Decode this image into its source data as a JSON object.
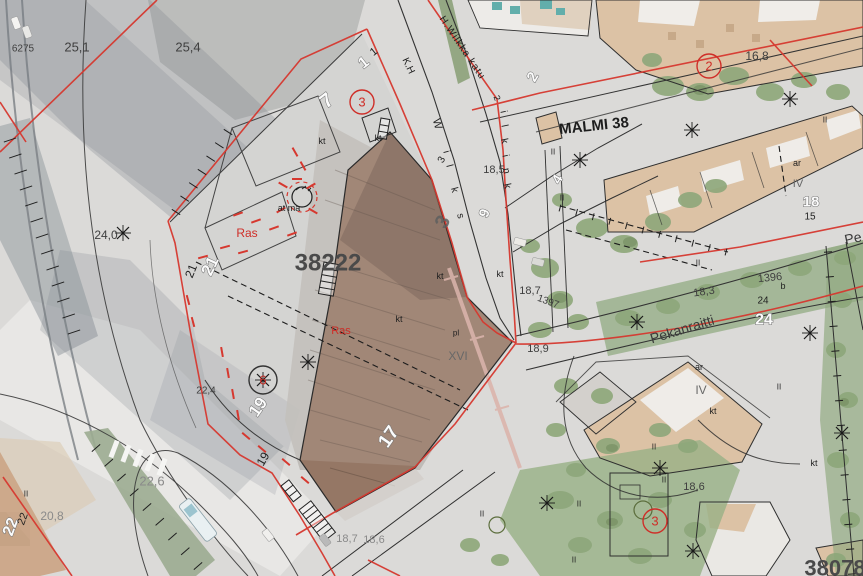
{
  "meta": {
    "map_type": "cadastral city-plan overlay on aerial photo",
    "district_label": "MALMI 38",
    "main_block_number": "38222",
    "secondary_block_number": "38078",
    "street_names": [
      "Pekanraitti",
      "H.Wilkka katu"
    ],
    "easement_label": "Ras"
  },
  "colors": {
    "red_line": "#d6382f",
    "plan_black": "#222222",
    "block_gray": "#4a4a4a",
    "photo_green": "#84a06f",
    "roof_beige": "#d9bd9e",
    "roof_brown": "#8c6c58",
    "teal_roof": "#55a8a4"
  },
  "labels": [
    {
      "n": "spot-height-6275",
      "t": "6275",
      "x": 23,
      "y": 49,
      "s": 10,
      "r": 0,
      "st": "elev"
    },
    {
      "n": "spot-height-25-1",
      "t": "25,1",
      "x": 77,
      "y": 47,
      "s": 13,
      "r": 0,
      "st": "elev"
    },
    {
      "n": "spot-height-25-4",
      "t": "25,4",
      "x": 188,
      "y": 47,
      "s": 13,
      "r": 0,
      "st": "elev"
    },
    {
      "n": "spot-height-24-0",
      "t": "24,0",
      "x": 106,
      "y": 235,
      "s": 12,
      "r": 0,
      "st": "elev"
    },
    {
      "n": "spot-height-18-5",
      "t": "18,5",
      "x": 494,
      "y": 170,
      "s": 11,
      "r": 0,
      "st": "elev"
    },
    {
      "n": "spot-height-18-7",
      "t": "18,7",
      "x": 530,
      "y": 291,
      "s": 11,
      "r": 0,
      "st": "elev"
    },
    {
      "n": "spot-height-18-9",
      "t": "18,9",
      "x": 538,
      "y": 349,
      "s": 11,
      "r": 0,
      "st": "elev"
    },
    {
      "n": "spot-height-16-8",
      "t": "16,8",
      "x": 757,
      "y": 56,
      "s": 12,
      "r": 0,
      "st": "elev"
    },
    {
      "n": "spot-height-18-3",
      "t": "18,3",
      "x": 704,
      "y": 292,
      "s": 11,
      "r": -8,
      "st": "elev"
    },
    {
      "n": "spot-height-22-4",
      "t": "22,4",
      "x": 206,
      "y": 391,
      "s": 10,
      "r": 0,
      "st": "elev"
    },
    {
      "n": "spot-height-22-6",
      "t": "22,6",
      "x": 152,
      "y": 481,
      "s": 13,
      "r": 0,
      "st": "elevlight"
    },
    {
      "n": "spot-height-20-8",
      "t": "20,8",
      "x": 52,
      "y": 516,
      "s": 12,
      "r": 0,
      "st": "elevlight"
    },
    {
      "n": "spot-height-18-6",
      "t": "18,6",
      "x": 694,
      "y": 487,
      "s": 11,
      "r": 0,
      "st": "elev"
    },
    {
      "n": "spot-height-18-7-b",
      "t": "18,7",
      "x": 347,
      "y": 539,
      "s": 11,
      "r": 0,
      "st": "elevlight"
    },
    {
      "n": "spot-height-18-6-b",
      "t": "18,6",
      "x": 374,
      "y": 540,
      "s": 11,
      "r": 0,
      "st": "elevlight"
    },
    {
      "n": "benchmark-1397",
      "t": "1397",
      "x": 548,
      "y": 302,
      "s": 10,
      "r": 20,
      "st": "elev"
    },
    {
      "n": "benchmark-1396",
      "t": "1396",
      "x": 770,
      "y": 278,
      "s": 11,
      "r": -6,
      "st": "elev"
    },
    {
      "n": "block-number-38222",
      "t": "38222",
      "x": 328,
      "y": 263,
      "s": 24,
      "r": 0,
      "st": "block"
    },
    {
      "n": "block-number-38078",
      "t": "38078",
      "x": 835,
      "y": 568,
      "s": 22,
      "r": 0,
      "st": "block"
    },
    {
      "n": "lot-number-7",
      "t": "7",
      "x": 327,
      "y": 101,
      "s": 20,
      "r": -38,
      "st": "lotw"
    },
    {
      "n": "lot-number-1",
      "t": "1",
      "x": 364,
      "y": 63,
      "s": 16,
      "r": -38,
      "st": "lotw"
    },
    {
      "n": "lot-number-1-b",
      "t": "1",
      "x": 374,
      "y": 52,
      "s": 11,
      "r": -38,
      "st": "smb"
    },
    {
      "n": "lot-number-21",
      "t": "21",
      "x": 210,
      "y": 266,
      "s": 17,
      "r": -65,
      "st": "lotw"
    },
    {
      "n": "lot-number-21-b",
      "t": "21",
      "x": 191,
      "y": 271,
      "s": 12,
      "r": -68,
      "st": "smb"
    },
    {
      "n": "lot-number-19",
      "t": "19",
      "x": 258,
      "y": 407,
      "s": 17,
      "r": -55,
      "st": "lotw"
    },
    {
      "n": "lot-number-19-b",
      "t": "19",
      "x": 263,
      "y": 459,
      "s": 12,
      "r": -60,
      "st": "smb"
    },
    {
      "n": "lot-number-17",
      "t": "17",
      "x": 389,
      "y": 437,
      "s": 19,
      "r": -55,
      "st": "lotw"
    },
    {
      "n": "lot-number-22",
      "t": "22",
      "x": 11,
      "y": 527,
      "s": 16,
      "r": -70,
      "st": "lotw"
    },
    {
      "n": "lot-number-22-b",
      "t": "22",
      "x": 23,
      "y": 519,
      "s": 11,
      "r": -70,
      "st": "smb"
    },
    {
      "n": "lot-number-2",
      "t": "2",
      "x": 533,
      "y": 77,
      "s": 15,
      "r": -60,
      "st": "lotw"
    },
    {
      "n": "lot-number-4",
      "t": "4",
      "x": 557,
      "y": 179,
      "s": 14,
      "r": -60,
      "st": "lotw"
    },
    {
      "n": "lot-number-24",
      "t": "24",
      "x": 764,
      "y": 320,
      "s": 16,
      "r": 0,
      "st": "lotw"
    },
    {
      "n": "lot-number-24-b",
      "t": "24",
      "x": 763,
      "y": 301,
      "s": 10,
      "r": 0,
      "st": "smb"
    },
    {
      "n": "lot-number-18",
      "t": "18",
      "x": 811,
      "y": 202,
      "s": 15,
      "r": 0,
      "st": "lotw"
    },
    {
      "n": "lot-number-15",
      "t": "15",
      "x": 810,
      "y": 217,
      "s": 10,
      "r": 0,
      "st": "smb"
    },
    {
      "n": "lot-number-9",
      "t": "9",
      "x": 484,
      "y": 213,
      "s": 14,
      "r": -70,
      "st": "lotw"
    },
    {
      "n": "lot-number-3-small",
      "t": "3",
      "x": 442,
      "y": 160,
      "s": 10,
      "r": -60,
      "st": "smb"
    },
    {
      "n": "lot-number-3-roof",
      "t": "3",
      "x": 443,
      "y": 222,
      "s": 20,
      "r": -60,
      "st": "blockmed"
    },
    {
      "n": "roman-floors-xvi",
      "t": "XVI",
      "x": 458,
      "y": 356,
      "s": 12,
      "r": 0,
      "st": "gray"
    },
    {
      "n": "roman-floors-iv",
      "t": "IV",
      "x": 701,
      "y": 390,
      "s": 12,
      "r": 0,
      "st": "gray"
    },
    {
      "n": "roman-floors-iv-b",
      "t": "IV",
      "x": 798,
      "y": 184,
      "s": 11,
      "r": 0,
      "st": "gray"
    },
    {
      "n": "note-pl",
      "t": "pl",
      "x": 456,
      "y": 333,
      "s": 8,
      "r": 0,
      "st": "smb"
    },
    {
      "n": "note-ar",
      "t": "ar",
      "x": 699,
      "y": 367,
      "s": 9,
      "r": 0,
      "st": "smb"
    },
    {
      "n": "note-ar-b",
      "t": "ar",
      "x": 797,
      "y": 163,
      "s": 9,
      "r": 0,
      "st": "smb"
    },
    {
      "n": "note-at-ma",
      "t": "at ma",
      "x": 289,
      "y": 208,
      "s": 9,
      "r": 0,
      "st": "smb"
    },
    {
      "n": "note-kt-1",
      "t": "kt",
      "x": 322,
      "y": 141,
      "s": 9,
      "r": 0,
      "st": "smb"
    },
    {
      "n": "note-kt-2",
      "t": "kt",
      "x": 378,
      "y": 138,
      "s": 9,
      "r": 0,
      "st": "smb"
    },
    {
      "n": "note-kt-3",
      "t": "kt",
      "x": 399,
      "y": 319,
      "s": 9,
      "r": 0,
      "st": "smb"
    },
    {
      "n": "note-kt-4",
      "t": "kt",
      "x": 440,
      "y": 276,
      "s": 9,
      "r": 0,
      "st": "smb"
    },
    {
      "n": "note-kt-5",
      "t": "kt",
      "x": 500,
      "y": 274,
      "s": 9,
      "r": 0,
      "st": "smb"
    },
    {
      "n": "note-kt-6",
      "t": "kt",
      "x": 713,
      "y": 411,
      "s": 9,
      "r": 0,
      "st": "smb"
    },
    {
      "n": "note-kt-7",
      "t": "kt",
      "x": 814,
      "y": 463,
      "s": 9,
      "r": 0,
      "st": "smb"
    },
    {
      "n": "note-b",
      "t": "b",
      "x": 783,
      "y": 286,
      "s": 9,
      "r": 0,
      "st": "smb"
    },
    {
      "n": "easement-ras-1",
      "t": "Ras",
      "x": 247,
      "y": 233,
      "s": 12,
      "r": 0,
      "st": "red"
    },
    {
      "n": "easement-ras-2",
      "t": "Ras",
      "x": 341,
      "y": 331,
      "s": 11,
      "r": 0,
      "st": "red"
    },
    {
      "n": "plan-circle-3a",
      "t": "3",
      "x": 362,
      "y": 102,
      "s": 13,
      "r": 0,
      "st": "red",
      "c": true,
      "cc": "#cf2e28",
      "cr": 12
    },
    {
      "n": "plan-circle-2",
      "t": "2",
      "x": 709,
      "y": 66,
      "s": 13,
      "r": 0,
      "st": "red",
      "c": true,
      "cc": "#cf2e28",
      "cr": 12
    },
    {
      "n": "plan-circle-3b",
      "t": "3",
      "x": 655,
      "y": 521,
      "s": 13,
      "r": 0,
      "st": "red",
      "c": true,
      "cc": "#cf2e28",
      "cr": 12
    },
    {
      "n": "plan-circle-6",
      "t": "6",
      "x": 263,
      "y": 380,
      "s": 13,
      "r": 0,
      "st": "red",
      "c": true,
      "cc": "#333333",
      "cr": 14
    },
    {
      "n": "district-malmi-38",
      "t": "MALMI 38",
      "x": 594,
      "y": 126,
      "s": 15,
      "r": -6,
      "st": "name"
    },
    {
      "n": "street-pekanraitti",
      "t": "Pekanraitti",
      "x": 682,
      "y": 329,
      "s": 14,
      "r": -17,
      "st": "street"
    },
    {
      "n": "street-pe-cut",
      "t": "Pe",
      "x": 853,
      "y": 238,
      "s": 14,
      "r": -12,
      "st": "street"
    },
    {
      "n": "street-h-wilkka-katu",
      "t": "H.Wilkka katu",
      "x": 462,
      "y": 48,
      "s": 10,
      "r": 56,
      "st": "smb",
      "ls": 1
    },
    {
      "n": "street-number-2",
      "t": "2",
      "x": 497,
      "y": 98,
      "s": 9,
      "r": 70,
      "st": "smb"
    },
    {
      "n": "street-letter-r1",
      "t": "i",
      "x": 503,
      "y": 112,
      "s": 10,
      "r": 78,
      "st": "smb"
    },
    {
      "n": "street-letter-r2",
      "t": "l",
      "x": 504,
      "y": 126,
      "s": 10,
      "r": 78,
      "st": "smb"
    },
    {
      "n": "street-letter-r3",
      "t": "k",
      "x": 504,
      "y": 141,
      "s": 10,
      "r": 78,
      "st": "smb"
    },
    {
      "n": "street-letter-r4",
      "t": "i",
      "x": 505,
      "y": 156,
      "s": 10,
      "r": 78,
      "st": "smb"
    },
    {
      "n": "street-letter-r5",
      "t": "n",
      "x": 506,
      "y": 171,
      "s": 10,
      "r": 78,
      "st": "smb"
    },
    {
      "n": "street-letter-r6",
      "t": "k",
      "x": 507,
      "y": 186,
      "s": 10,
      "r": 78,
      "st": "smb"
    },
    {
      "n": "street-letter-l0",
      "t": "K.H",
      "x": 408,
      "y": 66,
      "s": 10,
      "r": 65,
      "st": "smb"
    },
    {
      "n": "street-letter-l1",
      "t": "W",
      "x": 437,
      "y": 124,
      "s": 11,
      "r": 75,
      "st": "smb"
    },
    {
      "n": "street-letter-l2",
      "t": "i",
      "x": 446,
      "y": 152,
      "s": 10,
      "r": 75,
      "st": "smb"
    },
    {
      "n": "street-letter-l3",
      "t": "l",
      "x": 449,
      "y": 166,
      "s": 10,
      "r": 75,
      "st": "smb"
    },
    {
      "n": "street-letter-l4",
      "t": "k",
      "x": 454,
      "y": 190,
      "s": 10,
      "r": 75,
      "st": "smb"
    },
    {
      "n": "street-letter-l5",
      "t": "s",
      "x": 460,
      "y": 216,
      "s": 10,
      "r": 75,
      "st": "smb"
    }
  ],
  "symbols": {
    "ii_text": "II",
    "ii_marks": [
      [
        553,
        152
      ],
      [
        562,
        198
      ],
      [
        698,
        263
      ],
      [
        779,
        387
      ],
      [
        654,
        447
      ],
      [
        664,
        480
      ],
      [
        579,
        504
      ],
      [
        574,
        560
      ],
      [
        26,
        494
      ],
      [
        825,
        120
      ],
      [
        482,
        514
      ]
    ],
    "tree_stars": [
      [
        123,
        233
      ],
      [
        580,
        160
      ],
      [
        692,
        130
      ],
      [
        790,
        99
      ],
      [
        810,
        333
      ],
      [
        660,
        468
      ],
      [
        693,
        551
      ],
      [
        842,
        433
      ],
      [
        547,
        503
      ],
      [
        308,
        362
      ],
      [
        637,
        322
      ],
      [
        263,
        380
      ]
    ],
    "circle_trees": [
      [
        497,
        525,
        8
      ],
      [
        643,
        510,
        9
      ]
    ],
    "stairs": [
      {
        "x": 324,
        "y": 262,
        "w": 15,
        "h": 32,
        "rot": 10
      },
      {
        "x": 381,
        "y": 118,
        "w": 9,
        "h": 20,
        "rot": 10
      },
      {
        "x": 281,
        "y": 486,
        "w": 10,
        "h": 20,
        "rot": -38
      },
      {
        "x": 299,
        "y": 510,
        "w": 15,
        "h": 40,
        "rot": -38
      }
    ],
    "red_dashes": [
      [
        238,
        214,
        -20
      ],
      [
        256,
        221,
        -20
      ],
      [
        274,
        228,
        -20
      ],
      [
        292,
        234,
        -20
      ],
      [
        243,
        252,
        -15
      ],
      [
        225,
        247,
        -15
      ],
      [
        295,
        152,
        60
      ],
      [
        303,
        166,
        60
      ],
      [
        222,
        352,
        80
      ],
      [
        228,
        373,
        80
      ],
      [
        233,
        394,
        80
      ],
      [
        238,
        415,
        80
      ],
      [
        246,
        436,
        40
      ],
      [
        262,
        449,
        40
      ],
      [
        286,
        462,
        40
      ],
      [
        305,
        480,
        40
      ],
      [
        283,
        185,
        30
      ],
      [
        297,
        179,
        0
      ],
      [
        311,
        186,
        -30
      ],
      [
        281,
        210,
        150
      ],
      [
        313,
        211,
        210
      ],
      [
        203,
        257,
        -15
      ],
      [
        188,
        300,
        75
      ],
      [
        193,
        322,
        75
      ]
    ],
    "tick_rows": [
      {
        "x1": 228,
        "y1": 132,
        "x2": 176,
        "y2": 212,
        "n": 7,
        "len": 10
      },
      {
        "x1": 96,
        "y1": 448,
        "x2": 198,
        "y2": 566,
        "n": 9,
        "len": 11
      },
      {
        "x1": 10,
        "y1": 140,
        "x2": 74,
        "y2": 332,
        "n": 13,
        "len": 13
      },
      {
        "x1": 560,
        "y1": 208,
        "x2": 726,
        "y2": 252,
        "n": 11,
        "len": 7
      },
      {
        "x1": 828,
        "y1": 252,
        "x2": 852,
        "y2": 574,
        "n": 14,
        "len": 8
      }
    ],
    "crosswalk": {
      "x1": 114,
      "y1": 449,
      "x2": 162,
      "y2": 467,
      "n": 5,
      "len": 18
    },
    "crane": {
      "x1": 449,
      "y1": 268,
      "x2": 520,
      "y2": 468
    },
    "vehicles": {
      "bus": {
        "x": 198,
        "y": 520,
        "rot": -38,
        "w": 14,
        "h": 46
      },
      "cars": [
        [
          268,
          535,
          -38,
          "#f0efed"
        ],
        [
          325,
          540,
          -38,
          "#b9b9b9"
        ],
        [
          16,
          23,
          -20,
          "#f4f3f1"
        ],
        [
          27,
          32,
          -20,
          "#e8e8e6"
        ],
        [
          520,
          242,
          -75,
          "#eceae6"
        ],
        [
          538,
          262,
          -75,
          "#dadad6"
        ]
      ]
    }
  }
}
